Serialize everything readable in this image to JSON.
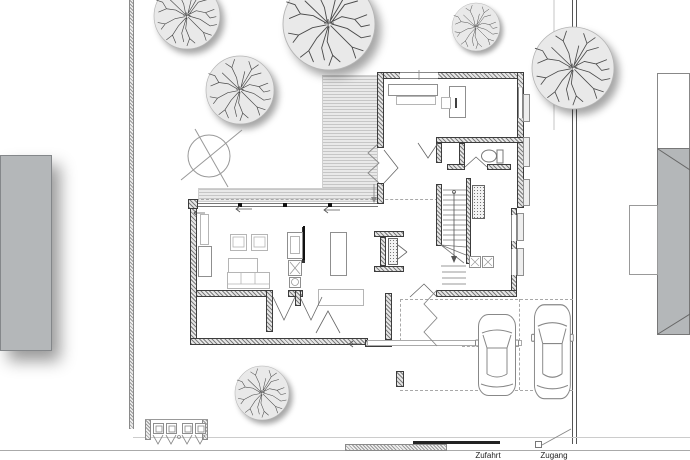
{
  "labels": {
    "zufahrt": "Zufahrt",
    "zugang": "Zugang"
  },
  "colors": {
    "background": "#ffffff",
    "neighbor_building_fill": "#b4b7b9",
    "tree_fill": "#e9e9e9",
    "tree_branch": "#4a4a4a",
    "wall_outline": "#3c3c3c",
    "deck_stripe": "#c6c6c6",
    "dashed_line": "#a8a8a8",
    "car_outline": "#888888",
    "text": "#222222"
  },
  "counts": {
    "trees": 6,
    "cars": 2,
    "waste_bins": 4
  }
}
